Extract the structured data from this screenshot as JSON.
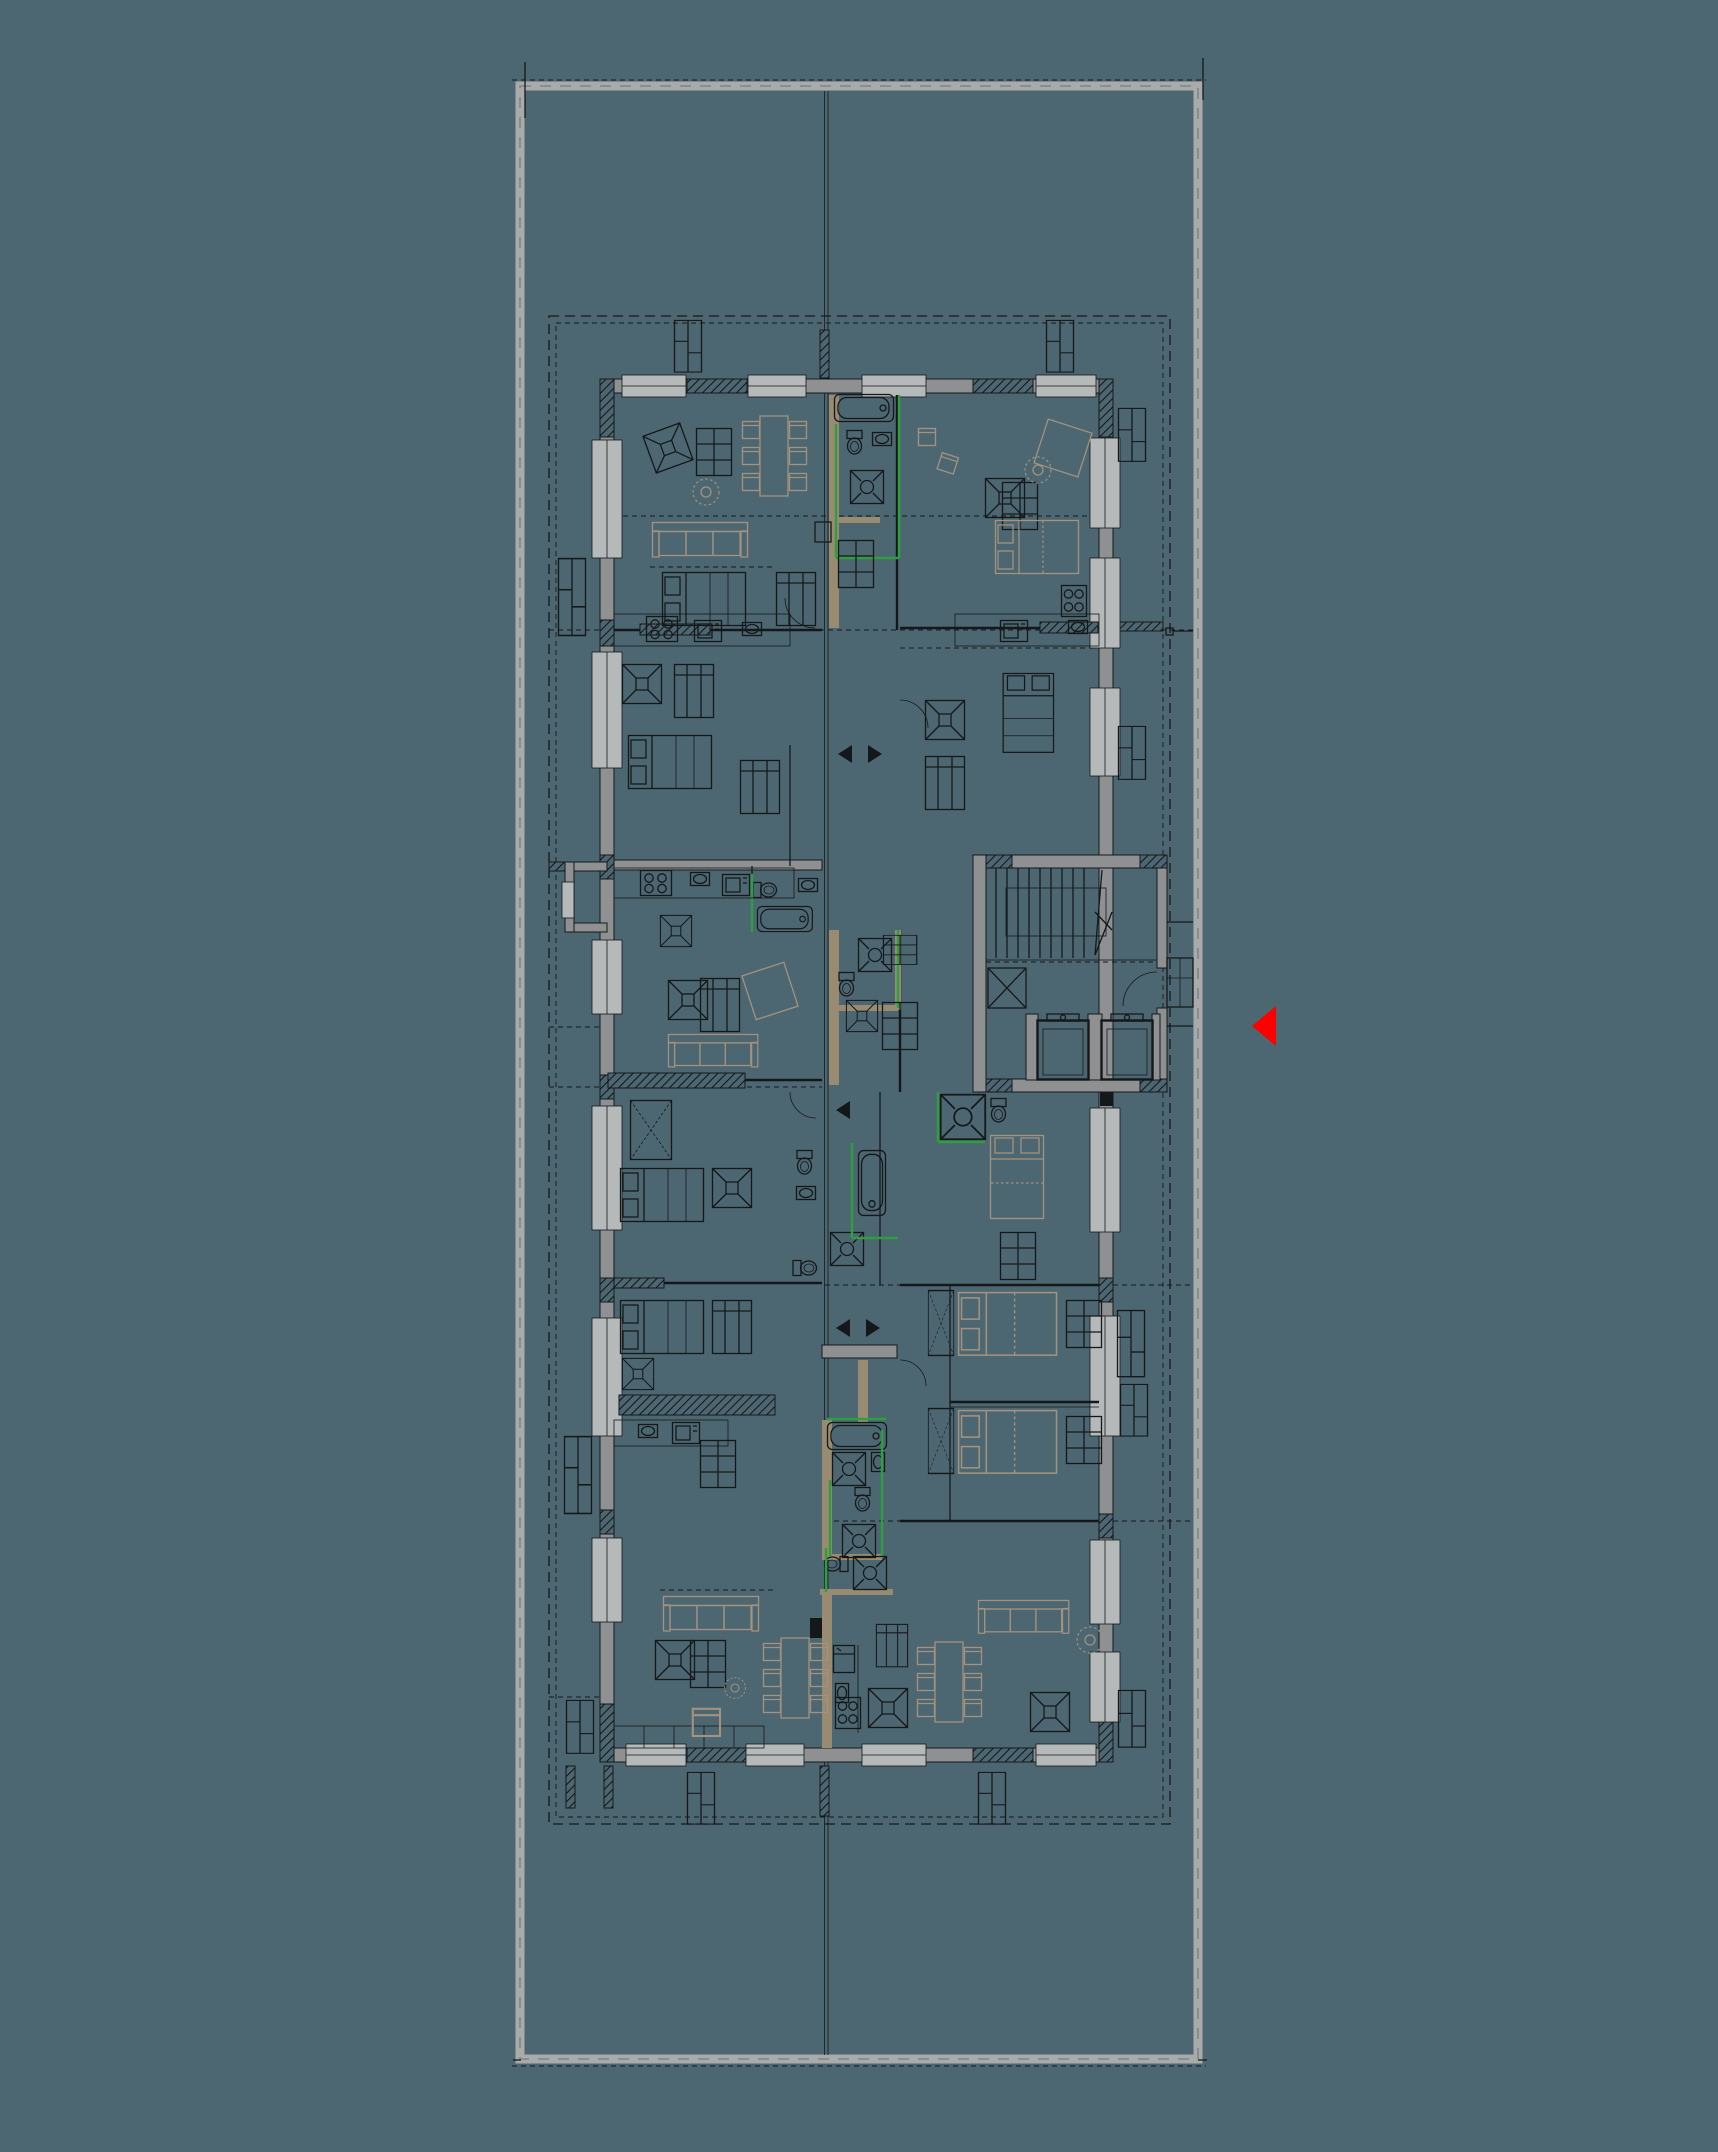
{
  "canvas": {
    "width": 1718,
    "height": 2152
  },
  "colors": {
    "background": "#4d6772",
    "boundaryGray": "#a9abab",
    "boundaryDash": "#7f8687",
    "ink": "#15181a",
    "wallGray": "#8e9092",
    "windowGray": "#b5b9b9",
    "tanWall": "#998b72",
    "furnitureTan": "#a3927d",
    "bathroomGreen": "#2f9e3f",
    "markerRed": "#fe0000"
  },
  "marker": {
    "shape": "triangle",
    "direction": "left",
    "color": "#fe0000"
  },
  "icons": {
    "entrance-marker": "red-triangle-left",
    "stair-flight": "parallel-treads",
    "elevator-car": "double-rect",
    "shaft": "square-with-x",
    "bathtub": "rounded-rect-oval",
    "toilet": "tank-and-bowl",
    "shower": "square-funnel-drain",
    "stove": "four-burner-circles",
    "bed": "rect-with-pillows",
    "wardrobe": "divided-rect",
    "ceiling-light": "pyramid-frustum-square",
    "window-box": "paned-rect",
    "door-arrow": "solid-triangle"
  }
}
